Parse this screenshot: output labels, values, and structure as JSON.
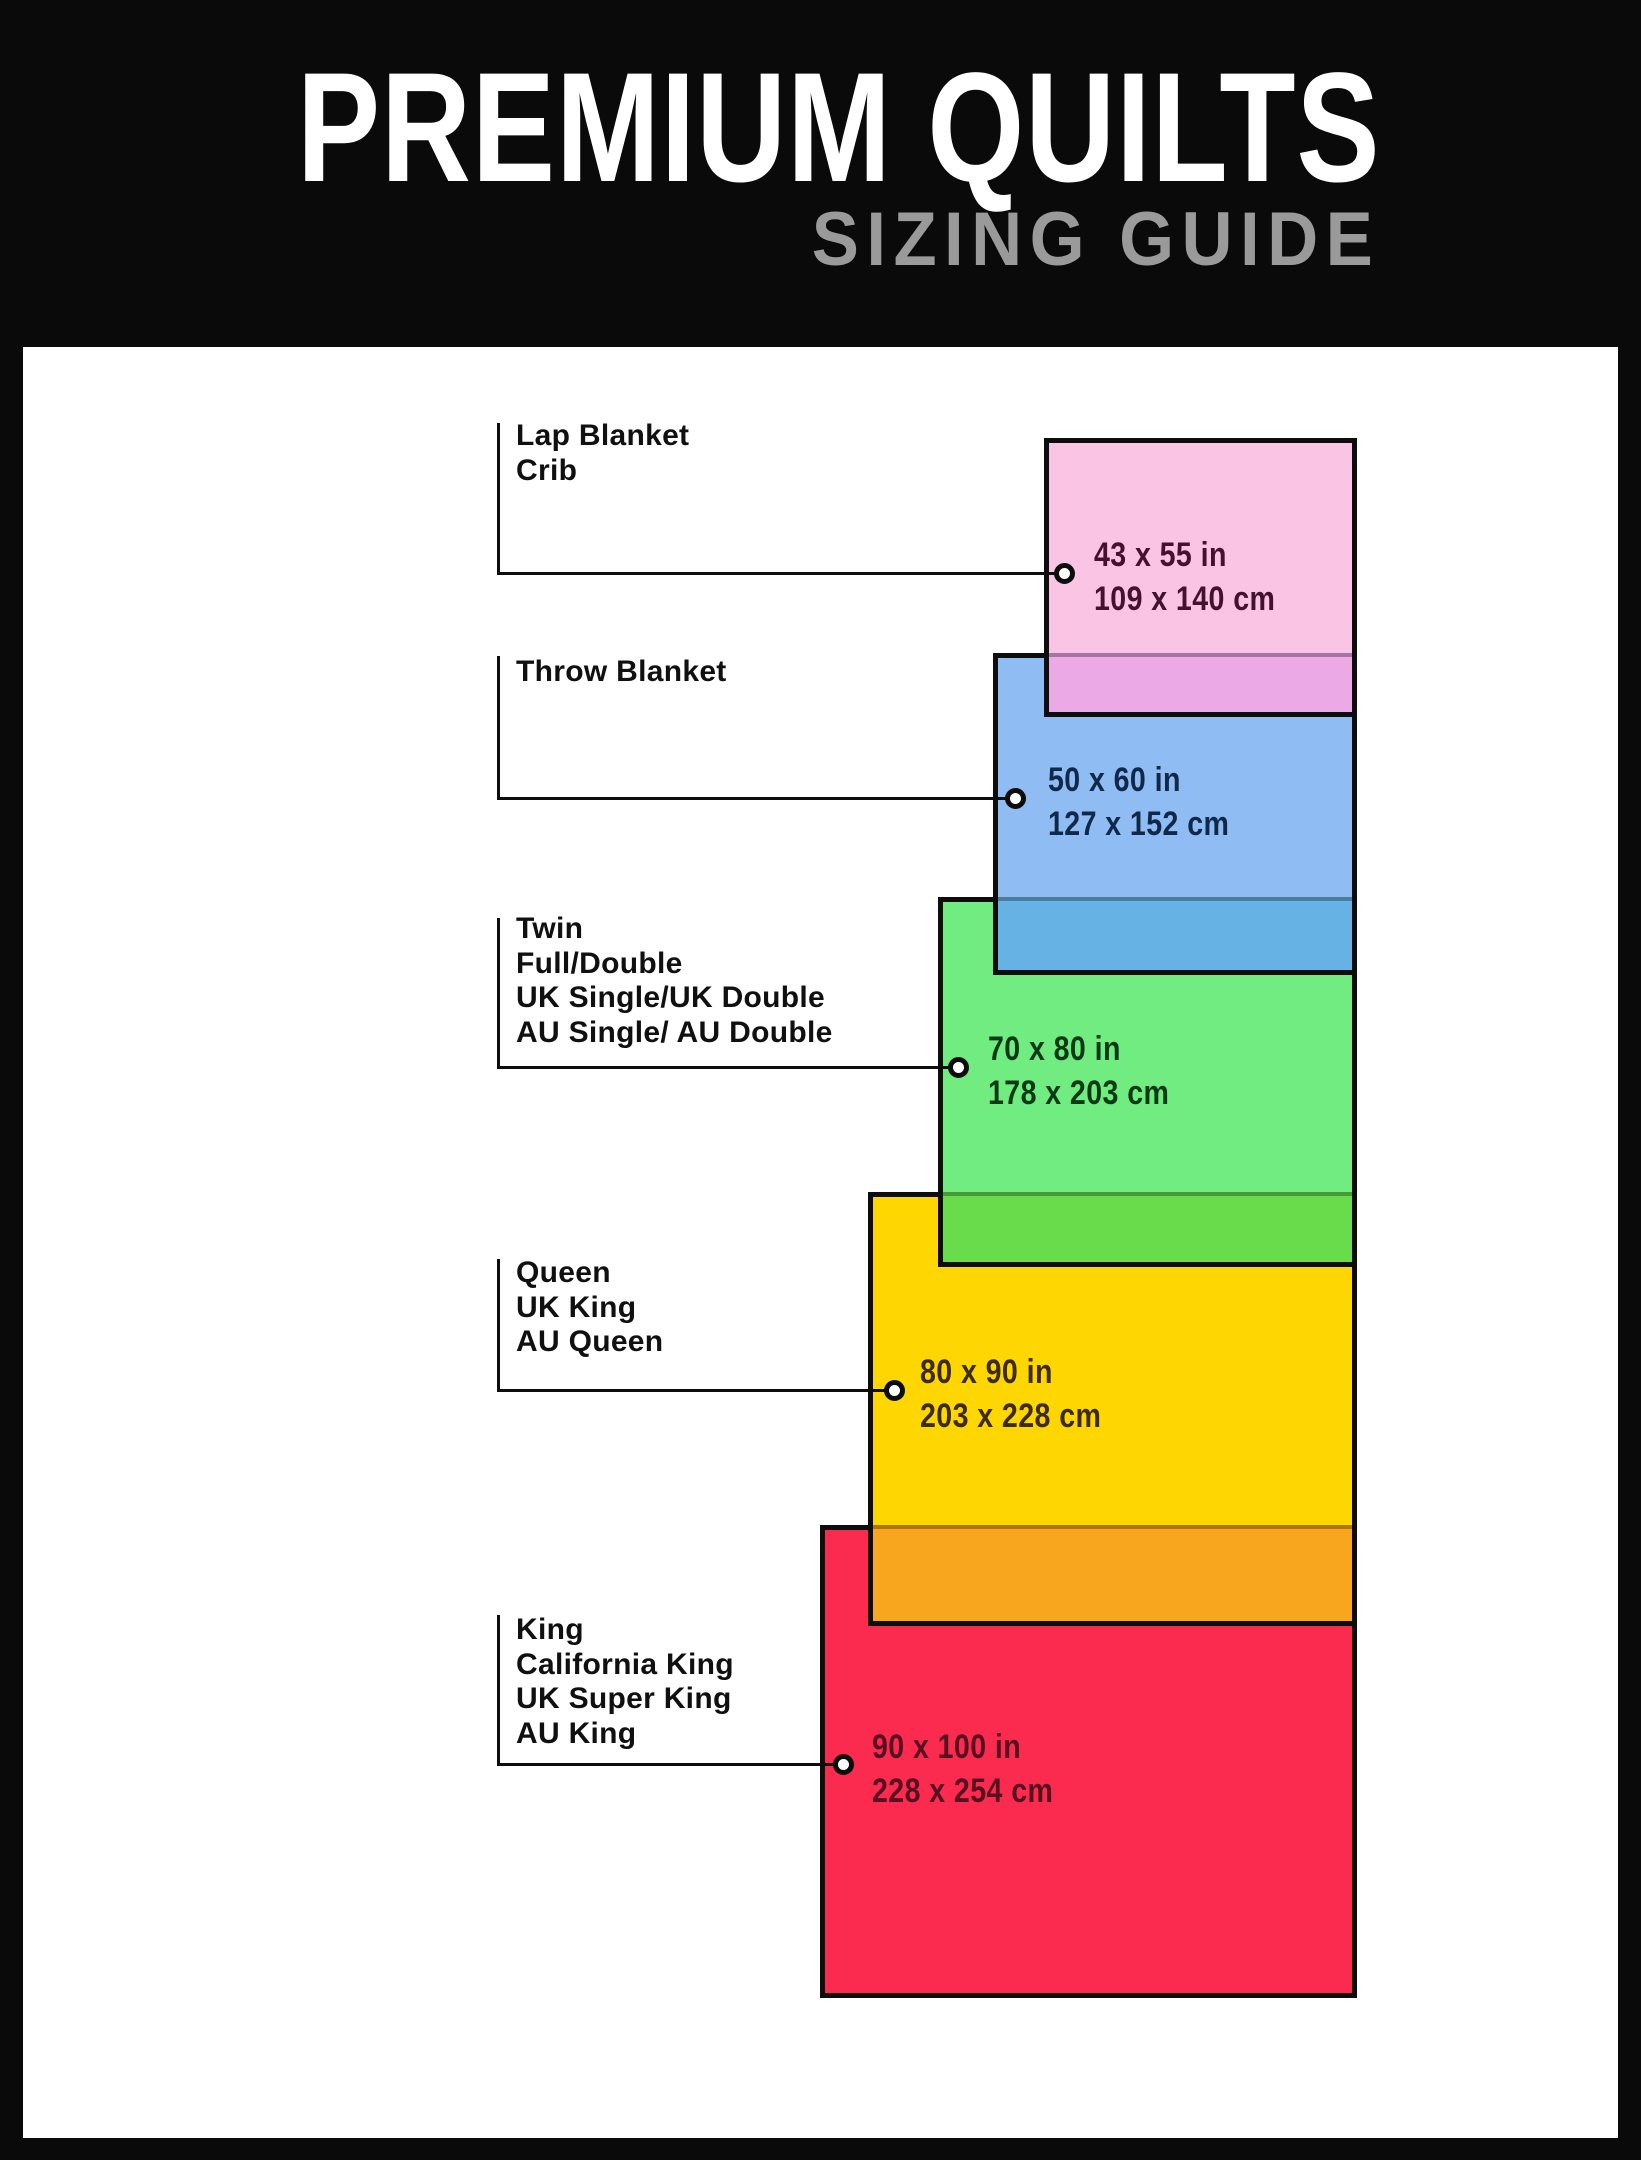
{
  "header": {
    "title": "PREMIUM QUILTS",
    "subtitle": "SIZING GUIDE",
    "title_color": "#ffffff",
    "subtitle_color": "#9a9a9a",
    "background": "#0a0a0a"
  },
  "panel_background": "#ffffff",
  "chart_data": {
    "type": "table",
    "title": "PREMIUM QUILTS SIZING GUIDE",
    "columns": [
      "size_names",
      "inches",
      "centimeters"
    ],
    "rows": [
      [
        [
          "Lap Blanket",
          "Crib"
        ],
        "43 x 55 in",
        "109 x 140 cm"
      ],
      [
        [
          "Throw Blanket"
        ],
        "50 x 60 in",
        "127 x 152 cm"
      ],
      [
        [
          "Twin",
          "Full/Double",
          "UK Single/UK Double",
          "AU Single/ AU Double"
        ],
        "70 x 80 in",
        "178 x 203 cm"
      ],
      [
        [
          "Queen",
          "UK King",
          "AU Queen"
        ],
        "80 x 90 in",
        "203 x 228 cm"
      ],
      [
        [
          "King",
          "California King",
          "UK Super King",
          "AU King"
        ],
        "90 x 100 in",
        "228 x 254 cm"
      ]
    ]
  },
  "sizes": [
    {
      "id": "lap-blanket-crib",
      "labels": [
        "Lap Blanket",
        "Crib"
      ],
      "inches": "43 x 55 in",
      "cm": "109 x 140 cm",
      "fill": "#FAC4E4",
      "overlap_fill": "#EBA9E6",
      "text_color": "#44112E",
      "geom": {
        "rect": [
          1044,
          438,
          313,
          279
        ],
        "band_h": 59,
        "circle": [
          1064,
          573
        ],
        "label_pos": [
          516,
          419
        ],
        "dims_pos": [
          1094,
          533
        ],
        "vline": [
          497,
          423,
          573
        ]
      }
    },
    {
      "id": "throw-blanket",
      "labels": [
        "Throw Blanket"
      ],
      "inches": "50 x 60 in",
      "cm": "127 x 152 cm",
      "fill": "#8FBCF2",
      "overlap_fill": "#66B2E4",
      "text_color": "#10294A",
      "geom": {
        "rect": [
          993,
          653,
          364,
          322
        ],
        "band_h": 73,
        "circle": [
          1015,
          798
        ],
        "label_pos": [
          516,
          655
        ],
        "dims_pos": [
          1048,
          758
        ],
        "vline": [
          497,
          656,
          798
        ]
      }
    },
    {
      "id": "twin-full-double",
      "labels": [
        "Twin",
        "Full/Double",
        "UK Single/UK Double",
        "AU Single/ AU Double"
      ],
      "inches": "70 x 80 in",
      "cm": "178 x 203 cm",
      "fill": "#70EC80",
      "overlap_fill": "#68DC4B",
      "text_color": "#0A3A15",
      "geom": {
        "rect": [
          938,
          897,
          419,
          370
        ],
        "band_h": 70,
        "circle": [
          958,
          1067
        ],
        "label_pos": [
          516,
          912
        ],
        "dims_pos": [
          988,
          1027
        ],
        "vline": [
          497,
          918,
          1067
        ]
      }
    },
    {
      "id": "queen-uk-king",
      "labels": [
        "Queen",
        "UK King",
        "AU Queen"
      ],
      "inches": "80 x 90 in",
      "cm": "203 x 228 cm",
      "fill": "#FED601",
      "overlap_fill": "#F8A61E",
      "text_color": "#3C2B03",
      "geom": {
        "rect": [
          868,
          1192,
          489,
          434
        ],
        "band_h": 96,
        "circle": [
          894,
          1390
        ],
        "label_pos": [
          516,
          1256
        ],
        "dims_pos": [
          920,
          1350
        ],
        "vline": [
          497,
          1259,
          1390
        ]
      }
    },
    {
      "id": "king-cal-king",
      "labels": [
        "King",
        "California King",
        "UK Super King",
        "AU King"
      ],
      "inches": "90 x 100 in",
      "cm": "228 x 254 cm",
      "fill": "#FA2B4E",
      "overlap_fill": null,
      "text_color": "#57101F",
      "geom": {
        "rect": [
          820,
          1525,
          537,
          473
        ],
        "band_h": 0,
        "circle": [
          843,
          1764
        ],
        "label_pos": [
          516,
          1613
        ],
        "dims_pos": [
          872,
          1725
        ],
        "vline": [
          497,
          1615,
          1764
        ]
      }
    }
  ]
}
